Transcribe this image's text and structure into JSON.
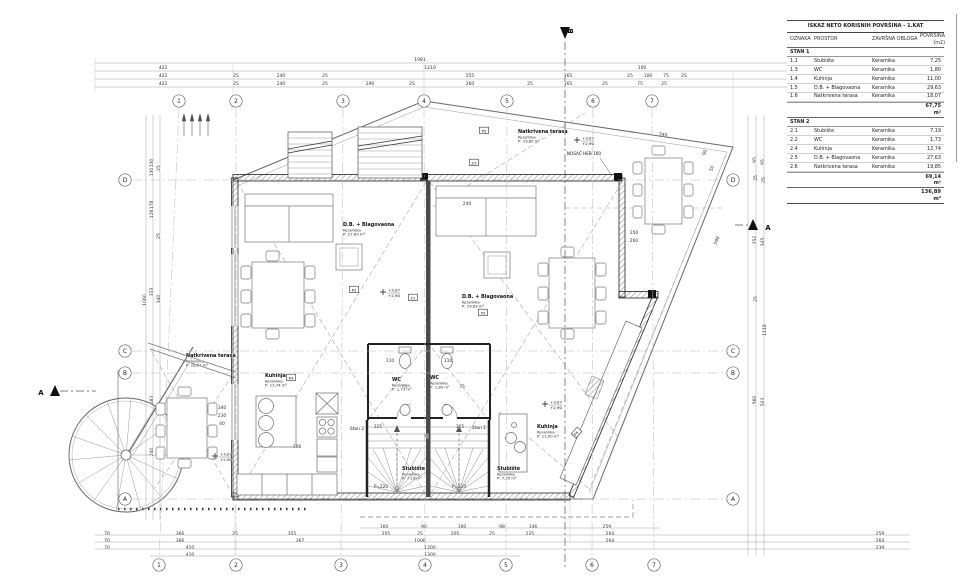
{
  "sheet": {
    "bg": "#ffffff",
    "line_color": "#333333",
    "wall_color": "#1a1a1a",
    "grid_color": "#b8b8b8"
  },
  "areas_table": {
    "title": "ISKAZ NETO KORISNIH POVRŠINA - 1.KAT",
    "headers": [
      "OZNAKA",
      "PROSTOR",
      "ZAVRŠNA OBLOGA",
      "POVRŠINA (m2)"
    ],
    "sections": [
      {
        "label": "STAN 1",
        "rows": [
          [
            "1.1",
            "Stubište",
            "Keramika",
            "7,25"
          ],
          [
            "1.3",
            "WC",
            "Keramika",
            "1,80"
          ],
          [
            "1.4",
            "Kuhinja",
            "Keramika",
            "11,00"
          ],
          [
            "1.5",
            "D.B. + Blagovaona",
            "Keramika",
            "29,63"
          ],
          [
            "1.6",
            "Natkrivena terasa",
            "Keramika",
            "18,07"
          ]
        ],
        "total": "67,75 m²"
      },
      {
        "label": "STAN 2",
        "rows": [
          [
            "2.1",
            "Stubište",
            "Keramika",
            "7,19"
          ],
          [
            "2.2",
            "WC",
            "Keramika",
            "1,73"
          ],
          [
            "2.4",
            "Kuhinja",
            "Keramika",
            "12,74"
          ],
          [
            "2.5",
            "D.B. + Blagovaona",
            "Keramika",
            "27,63"
          ],
          [
            "2.6",
            "Natkrivena terasa",
            "Keramika",
            "19,85"
          ]
        ],
        "total": "69,14 m²"
      }
    ],
    "grand_total": "136,89 m²"
  },
  "plan": {
    "grid": {
      "top_y": 101,
      "bottom_y": 565,
      "left_x": 125,
      "right_x": 733,
      "cols": [
        {
          "n": "1",
          "tx": 179,
          "bx": 159
        },
        {
          "n": "2",
          "tx": 236,
          "bx": 236
        },
        {
          "n": "3",
          "tx": 343,
          "bx": 341
        },
        {
          "n": "4",
          "tx": 424,
          "bx": 425
        },
        {
          "n": "5",
          "tx": 507,
          "bx": 506
        },
        {
          "n": "6",
          "tx": 593,
          "bx": 592
        },
        {
          "n": "7",
          "tx": 652,
          "bx": 654
        }
      ],
      "rows": [
        {
          "n": "D",
          "y": 180
        },
        {
          "n": "C",
          "y": 351
        },
        {
          "n": "B",
          "y": 373
        },
        {
          "n": "A",
          "y": 499
        }
      ]
    },
    "room_labels": [
      {
        "x": 186,
        "y": 357,
        "name": "Natkrivena terasa",
        "material": "Keramika",
        "area": "P: 18,07 m²"
      },
      {
        "x": 518,
        "y": 133,
        "name": "Natkrivena terasa",
        "material": "Keramika",
        "area": "P: 19,85 m²"
      },
      {
        "x": 343,
        "y": 226,
        "name": "D.B. + Blagovaona",
        "material": "Keramika",
        "area": "P: 27,63 m²"
      },
      {
        "x": 462,
        "y": 298,
        "name": "D.B. + Blagovaona",
        "material": "Keramika",
        "area": "P: 29,63 m²"
      },
      {
        "x": 265,
        "y": 377,
        "name": "Kuhinja",
        "material": "Keramika",
        "area": "P: 12,74 m²"
      },
      {
        "x": 537,
        "y": 428,
        "name": "Kuhinja",
        "material": "Keramika",
        "area": "P: 11,00 m²"
      },
      {
        "x": 392,
        "y": 381,
        "name": "WC",
        "material": "Keramika",
        "area": "P: 1,73 m²"
      },
      {
        "x": 430,
        "y": 379,
        "name": "WC",
        "material": "Keramika",
        "area": "P: 1,80 m²"
      },
      {
        "x": 402,
        "y": 470,
        "name": "Stubište",
        "material": "Keramika",
        "area": "P: 7,19 m²"
      },
      {
        "x": 497,
        "y": 470,
        "name": "Stubište",
        "material": "Keramika",
        "area": "P: 7,25 m²"
      }
    ],
    "stan_labels": [
      {
        "x": 357,
        "y": 430,
        "t": "Stan 2"
      },
      {
        "x": 479,
        "y": 429,
        "t": "Stan 1"
      }
    ],
    "markers": [
      {
        "x": 354,
        "y": 290,
        "t": "P2"
      },
      {
        "x": 413,
        "y": 298,
        "t": "Z1"
      },
      {
        "x": 483,
        "y": 313,
        "t": "P3"
      },
      {
        "x": 291,
        "y": 378,
        "t": "P4"
      },
      {
        "x": 577,
        "y": 433,
        "t": "P4",
        "r": -48
      },
      {
        "x": 484,
        "y": 131,
        "t": "P5"
      },
      {
        "x": 474,
        "y": 163,
        "t": "Z3"
      }
    ],
    "elevations": [
      {
        "x": 383,
        "y": 292,
        "a": "+3,07",
        "b": "+2,90"
      },
      {
        "x": 577,
        "y": 140,
        "a": "+3,07",
        "b": "+2,90"
      },
      {
        "x": 545,
        "y": 404,
        "a": "+3,07",
        "b": "+2,90"
      },
      {
        "x": 215,
        "y": 456,
        "a": "+3,07",
        "b": "+2,90"
      }
    ],
    "texts": [
      {
        "x": 584,
        "y": 155,
        "t": "NOSAČ HEB 160"
      },
      {
        "x": 381,
        "y": 488,
        "t": "P=220"
      },
      {
        "x": 459,
        "y": 488,
        "t": "P=220"
      }
    ],
    "section_labels": [
      {
        "x": 573,
        "y": 31,
        "t": "B",
        "r": -90
      },
      {
        "x": 768,
        "y": 230,
        "t": "A"
      },
      {
        "x": 41,
        "y": 395,
        "t": "A"
      }
    ],
    "dims": [
      [
        420,
        61,
        "1981"
      ],
      [
        163,
        69,
        "422"
      ],
      [
        430,
        69,
        "1210"
      ],
      [
        642,
        69,
        "100"
      ],
      [
        930,
        69,
        "248"
      ],
      [
        163,
        77,
        "422"
      ],
      [
        236,
        77,
        "25"
      ],
      [
        281,
        77,
        "240"
      ],
      [
        325,
        77,
        "25"
      ],
      [
        470,
        77,
        "555"
      ],
      [
        568,
        77,
        "165"
      ],
      [
        630,
        77,
        "25"
      ],
      [
        648,
        77,
        "100"
      ],
      [
        666,
        77,
        "75"
      ],
      [
        684,
        77,
        "25"
      ],
      [
        885,
        77,
        "296"
      ],
      [
        930,
        77,
        "249"
      ],
      [
        163,
        85,
        "422"
      ],
      [
        236,
        85,
        "25"
      ],
      [
        281,
        85,
        "240"
      ],
      [
        325,
        85,
        "25"
      ],
      [
        370,
        85,
        "290"
      ],
      [
        412,
        85,
        "25"
      ],
      [
        470,
        85,
        "260"
      ],
      [
        530,
        85,
        "25"
      ],
      [
        568,
        85,
        "165"
      ],
      [
        605,
        85,
        "25"
      ],
      [
        640,
        85,
        "75"
      ],
      [
        664,
        85,
        "25"
      ],
      [
        885,
        85,
        "296"
      ],
      [
        384,
        528,
        "160"
      ],
      [
        424,
        528,
        "90"
      ],
      [
        462,
        528,
        "160"
      ],
      [
        502,
        528,
        "98"
      ],
      [
        533,
        528,
        "146"
      ],
      [
        607,
        528,
        "259"
      ],
      [
        107,
        535,
        "70"
      ],
      [
        180,
        535,
        "366"
      ],
      [
        235,
        535,
        "25"
      ],
      [
        292,
        535,
        "355"
      ],
      [
        386,
        535,
        "205"
      ],
      [
        420,
        535,
        "25"
      ],
      [
        455,
        535,
        "205"
      ],
      [
        492,
        535,
        "25"
      ],
      [
        530,
        535,
        "225"
      ],
      [
        610,
        535,
        "264"
      ],
      [
        880,
        535,
        "259"
      ],
      [
        107,
        542,
        "70"
      ],
      [
        180,
        542,
        "366"
      ],
      [
        300,
        542,
        "367"
      ],
      [
        420,
        542,
        "1006"
      ],
      [
        610,
        542,
        "264"
      ],
      [
        880,
        542,
        "264"
      ],
      [
        107,
        549,
        "70"
      ],
      [
        190,
        549,
        "410"
      ],
      [
        430,
        549,
        "1200"
      ],
      [
        880,
        549,
        "239"
      ],
      [
        190,
        556,
        "410"
      ],
      [
        430,
        556,
        "1300"
      ],
      [
        146,
        300,
        "1060",
        -90
      ],
      [
        153,
        163,
        "130",
        -90
      ],
      [
        153,
        172,
        "130",
        -90
      ],
      [
        160,
        168,
        "25",
        -90
      ],
      [
        153,
        205,
        "178",
        -90
      ],
      [
        153,
        214,
        "128",
        -90
      ],
      [
        160,
        236,
        "25",
        -90
      ],
      [
        153,
        292,
        "353",
        -90
      ],
      [
        160,
        299,
        "340",
        -90
      ],
      [
        153,
        400,
        "183",
        -90
      ],
      [
        153,
        452,
        "240",
        -90
      ],
      [
        756,
        160,
        "95",
        -90
      ],
      [
        764,
        162,
        "95",
        -90
      ],
      [
        757,
        178,
        "25",
        -90
      ],
      [
        765,
        180,
        "25",
        -90
      ],
      [
        756,
        240,
        "352",
        -90
      ],
      [
        764,
        242,
        "345",
        -90
      ],
      [
        757,
        299,
        "25",
        -90
      ],
      [
        766,
        330,
        "1118",
        -90
      ],
      [
        756,
        400,
        "560",
        -90
      ],
      [
        764,
        402,
        "503",
        -90
      ],
      [
        467,
        205,
        "240"
      ],
      [
        663,
        136,
        "340",
        8
      ],
      [
        706,
        153,
        "90",
        -69
      ],
      [
        713,
        169,
        "50",
        -69
      ],
      [
        718,
        241,
        "590",
        -67
      ],
      [
        634,
        234,
        "350"
      ],
      [
        634,
        242,
        "260"
      ],
      [
        378,
        428,
        "325"
      ],
      [
        460,
        428,
        "325"
      ],
      [
        428,
        436,
        "25",
        -90
      ],
      [
        390,
        362,
        "110"
      ],
      [
        448,
        362,
        "110"
      ],
      [
        404,
        388,
        "75"
      ],
      [
        462,
        388,
        "75"
      ],
      [
        297,
        448,
        "366"
      ],
      [
        222,
        409,
        "340"
      ],
      [
        222,
        417,
        "230"
      ],
      [
        222,
        425,
        "40"
      ]
    ]
  }
}
